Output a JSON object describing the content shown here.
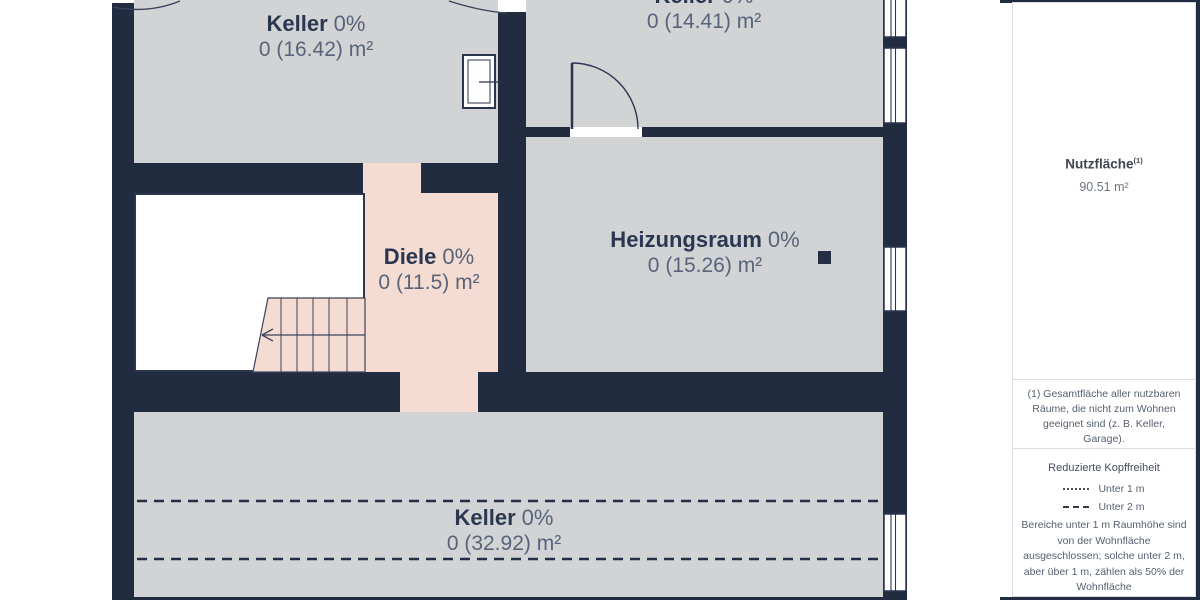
{
  "plan": {
    "rooms": [
      {
        "id": "keller-nw",
        "name": "Keller",
        "percent": "0%",
        "area": "0 (16.42) m²"
      },
      {
        "id": "keller-ne",
        "name": "Keller",
        "percent": "0%",
        "area": "0 (14.41) m²"
      },
      {
        "id": "diele",
        "name": "Diele",
        "percent": "0%",
        "area": "0 (11.5) m²"
      },
      {
        "id": "heizungsraum",
        "name": "Heizungsraum",
        "percent": "0%",
        "area": "0 (15.26) m²"
      },
      {
        "id": "keller-s",
        "name": "Keller",
        "percent": "0%",
        "area": "0 (32.92) m²"
      }
    ],
    "colors": {
      "wall": "#212c41",
      "room_fill": "#d2d3d5",
      "diele_fill": "#f4dcd2",
      "room_name_text": "#2b3750",
      "room_value_text": "#59647a"
    }
  },
  "sidebar": {
    "summary": {
      "title": "Nutzfläche",
      "superscript": "(1)",
      "value": "90.51 m²"
    },
    "note": "(1) Gesamtfläche aller nutzbaren Räume, die nicht zum Wohnen geeignet sind (z. B. Keller, Garage).",
    "legend": {
      "title": "Reduzierte Kopffreiheit",
      "items": [
        {
          "style": "dotted",
          "label": "Unter 1 m"
        },
        {
          "style": "dashed",
          "label": "Unter 2 m"
        }
      ],
      "description": "Bereiche unter 1 m Raumhöhe sind von der Wohnfläche ausgeschlossen; solche unter 2 m, aber über 1 m, zählen als 50% der Wohnfläche"
    }
  }
}
